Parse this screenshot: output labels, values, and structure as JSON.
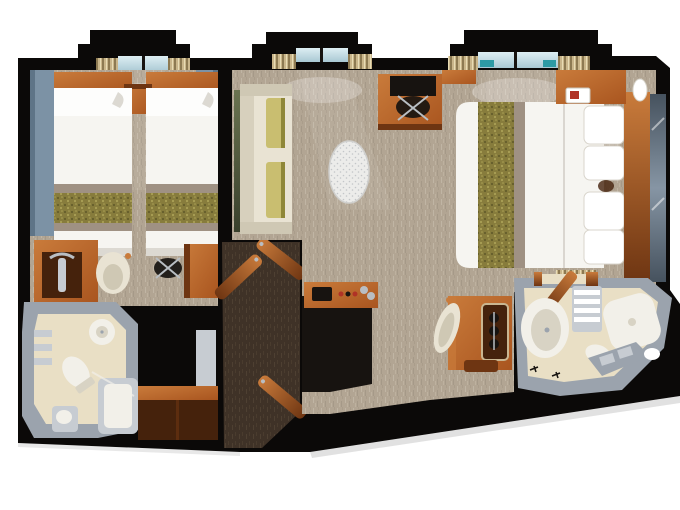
{
  "scene": {
    "type": "floor-plan",
    "description": "top-down 3D rendered floor plan of a two-bedroom ship suite with connecting corridor",
    "rooms": [
      {
        "name": "twin-bedroom"
      },
      {
        "name": "master-bedroom"
      },
      {
        "name": "bathroom-left"
      },
      {
        "name": "bathroom-right"
      },
      {
        "name": "entry-corridor"
      }
    ],
    "furniture": {
      "twin_bedroom": [
        "twin-bed",
        "twin-bed",
        "nightstand",
        "headboard-shelf",
        "wardrobe",
        "armchair",
        "desk",
        "desk-chair",
        "wall-panels",
        "window",
        "curtains"
      ],
      "master_bedroom": [
        "queen-bed",
        "headboard",
        "mirror-panel",
        "sofa",
        "sofa-pillows",
        "wall-art",
        "desk",
        "desk-chair",
        "oval-rug",
        "minibar-console",
        "vanity-dresser",
        "vanity-chair",
        "hanging-closet",
        "nightstand-with-phone",
        "nightstand",
        "table-lamp",
        "table-lamp",
        "windows",
        "curtains"
      ],
      "bathroom_left": [
        "washbasin",
        "toilet",
        "bathtub",
        "shelves",
        "pedestal-sink"
      ],
      "bathroom_right": [
        "round-shower",
        "toilet",
        "bathtub",
        "double-sink-vanity",
        "towel-stack",
        "towels"
      ],
      "entry_corridor": [
        "entry-door",
        "twin-room-door",
        "master-room-door",
        "bathroom-door",
        "hall-closet"
      ]
    }
  },
  "palette": {
    "page_bg": "#ffffff",
    "wall": "#0b0908",
    "carpet_base": "#b2a593",
    "carpet_streak_light": "#c7bdac",
    "carpet_streak_dark": "#9d9180",
    "corridor_base": "#3f3227",
    "corridor_streak": "#5a4a3a",
    "wood_light": "#c97b3b",
    "wood": "#a9551f",
    "wood_dark": "#6e3512",
    "wood_face": "#45220c",
    "bedding": "#f6f5f1",
    "bedding_shade": "#dcd9d2",
    "runner_base": "#877c3c",
    "runner_dot_dark": "#655d2b",
    "runner_dot_light": "#aaa055",
    "runner_band": "#9f9183",
    "panel_blue": "#7c92a5",
    "panel_blue_dark": "#5e7487",
    "glass_light": "#ddeef3",
    "glass_dark": "#a9c8d3",
    "glass_teal": "#2d9aa4",
    "curtain_base": "#c9b58a",
    "curtain_dark": "#8d7a52",
    "curtain_light": "#e8dcb4",
    "counter": "#9ba3ad",
    "counter_light": "#c7ccd2",
    "tile": "#e9dfc5",
    "fixture": "#f2f0e9",
    "fixture_shade": "#d8d3c4",
    "sofa": "#e9e3d3",
    "sofa_shade": "#cfc8b4",
    "pillow": "#c9be70",
    "pillow_dark": "#8f8738",
    "art_dark": "#39402c",
    "art_light": "#6a7350",
    "mirror_dark": "#46525e",
    "mirror_light": "#8695a4",
    "rug_base": "#ececea",
    "rug_dot": "#c3c6c9",
    "metal": "#b9bec3",
    "black_detail": "#171310",
    "red_accent": "#b03226",
    "shadow": "#bdbdbd"
  }
}
